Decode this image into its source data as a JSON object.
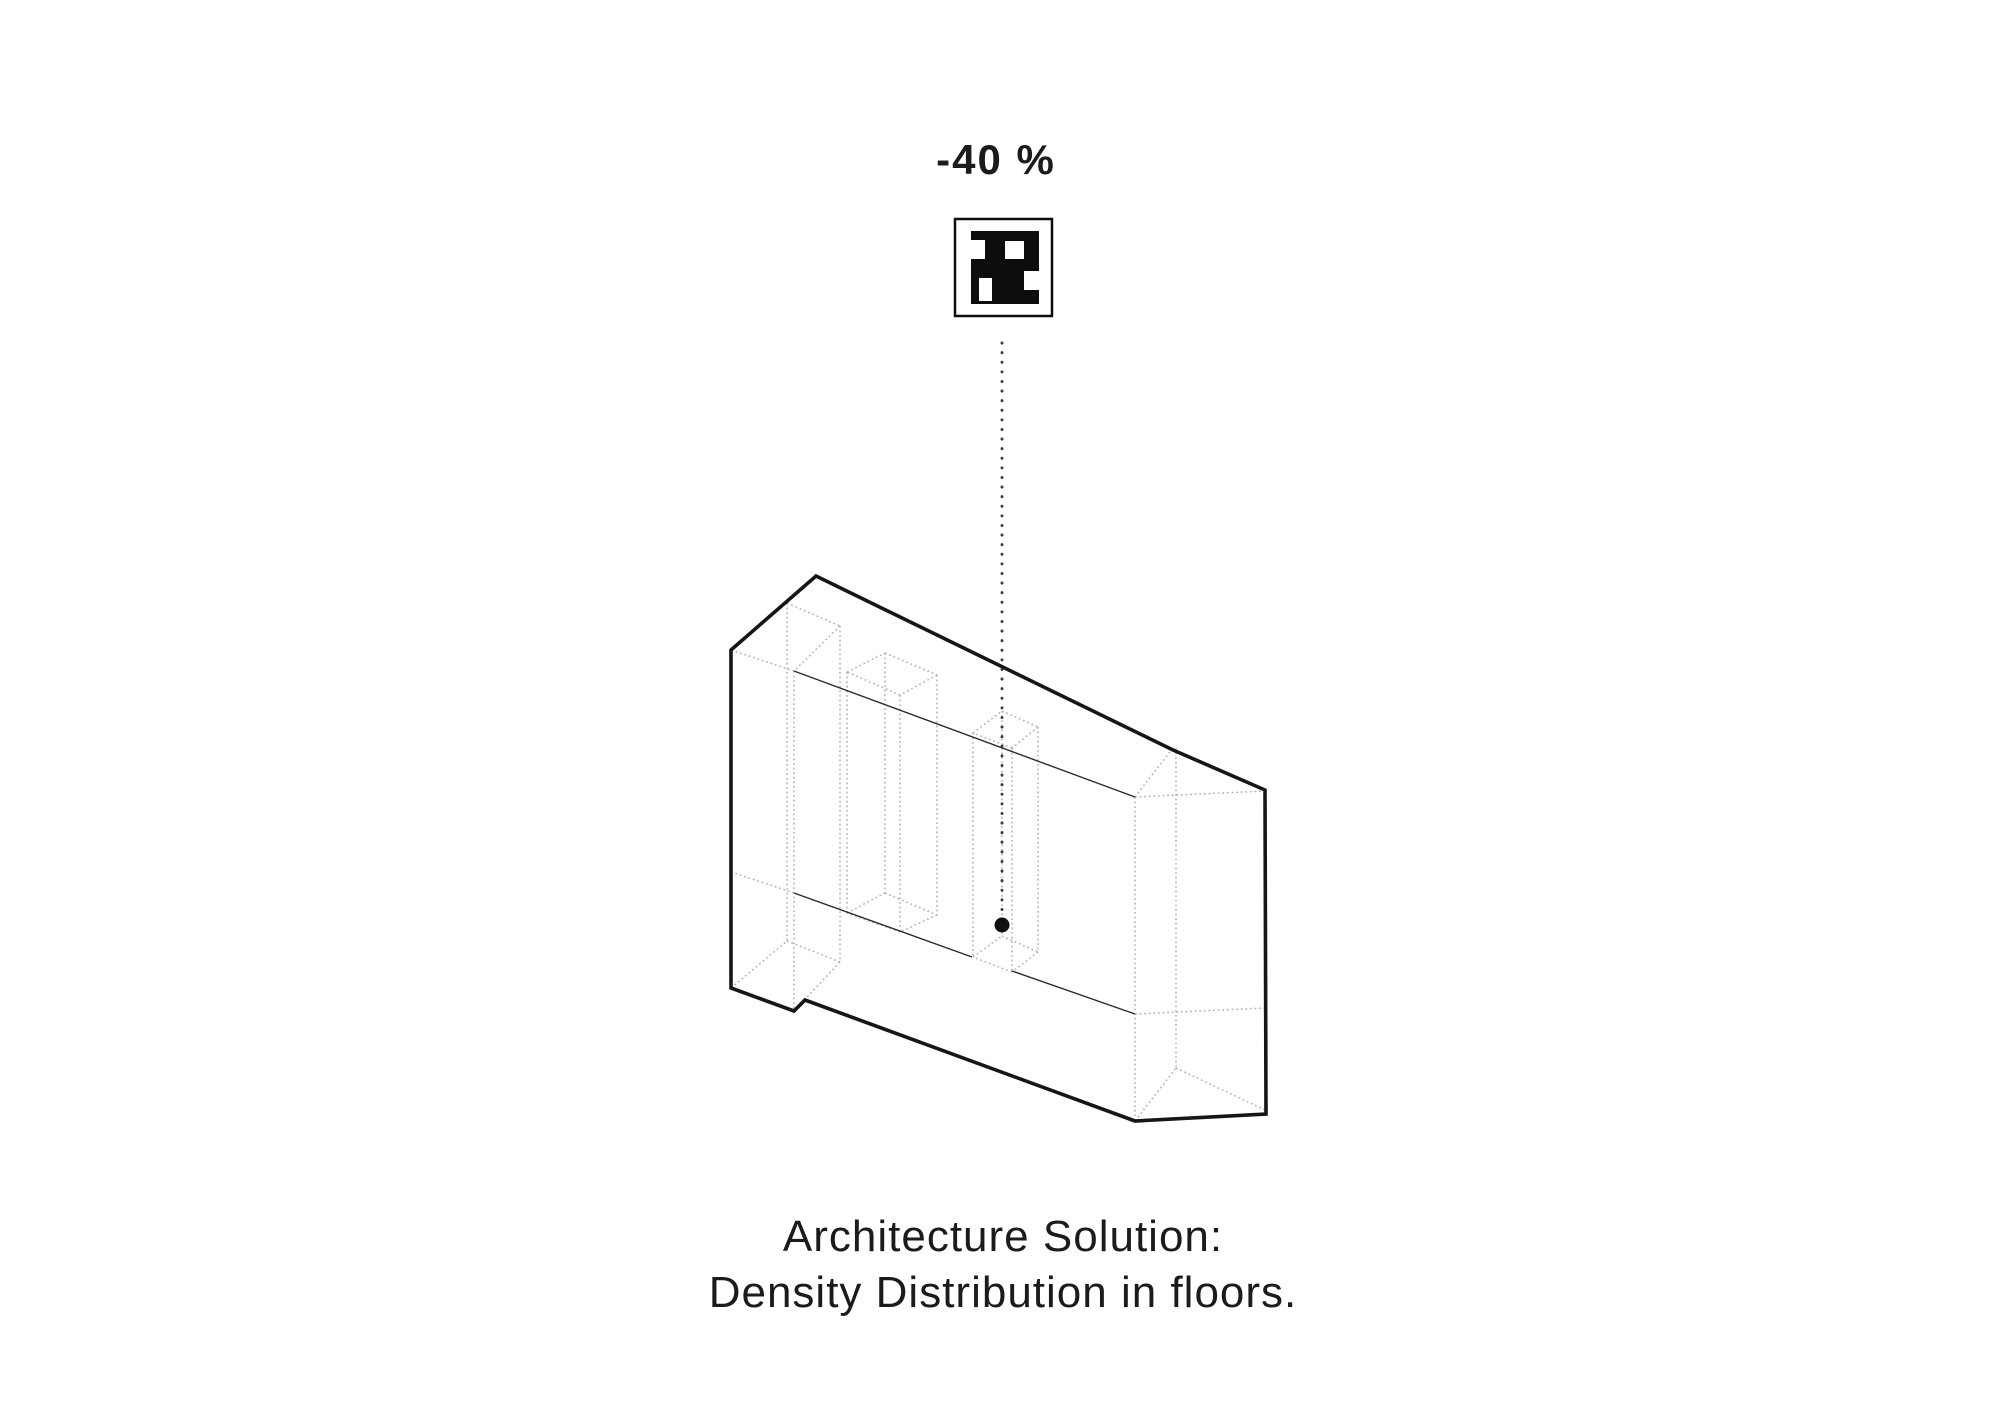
{
  "header": {
    "label": "-40 %"
  },
  "caption": {
    "line1": "Architecture Solution:",
    "line2": "Density Distribution in floors."
  },
  "colors": {
    "background": "#ffffff",
    "outline": "#161616",
    "floor_line": "#2b2b2b",
    "hidden_edge": "#b2b2b2",
    "pointer": "#3a3a3a",
    "dot": "#101010",
    "marker_black": "#0d0d0d",
    "text": "#1b1b1b"
  },
  "marker": {
    "border": {
      "x": 955,
      "y": 219,
      "w": 97,
      "h": 97
    },
    "black_base": {
      "x": 971,
      "y": 231,
      "w": 68,
      "h": 73
    },
    "white_cells": [
      {
        "x": 971,
        "y": 240,
        "w": 14,
        "h": 19
      },
      {
        "x": 1005,
        "y": 241,
        "w": 19,
        "h": 18
      },
      {
        "x": 1024,
        "y": 271,
        "w": 15,
        "h": 19
      },
      {
        "x": 979,
        "y": 278,
        "w": 13,
        "h": 23
      }
    ]
  },
  "pointer": {
    "x": 1002,
    "y1": 343,
    "y2": 916,
    "dot": {
      "cx": 1002,
      "cy": 925,
      "r": 7.5
    }
  },
  "building": {
    "outline": [
      [
        816,
        576
      ],
      [
        1173,
        750
      ],
      [
        1265,
        790
      ],
      [
        1266,
        1114
      ],
      [
        1135,
        1121
      ],
      [
        805,
        1000
      ],
      [
        794,
        1011
      ],
      [
        731,
        988
      ],
      [
        731,
        650
      ]
    ],
    "floor_lines": [
      [
        794,
        671,
        1135,
        797
      ],
      [
        794,
        893,
        972,
        957
      ],
      [
        1012,
        971,
        1135,
        1014
      ]
    ],
    "hidden_edges": [
      [
        731,
        650,
        787,
        603
      ],
      [
        787,
        603,
        840,
        626
      ],
      [
        840,
        626,
        794,
        671
      ],
      [
        794,
        671,
        731,
        650
      ],
      [
        787,
        603,
        787,
        941
      ],
      [
        840,
        626,
        840,
        962
      ],
      [
        794,
        671,
        794,
        1011
      ],
      [
        731,
        988,
        787,
        941
      ],
      [
        787,
        941,
        840,
        962
      ],
      [
        840,
        962,
        794,
        1011
      ],
      [
        731,
        872,
        794,
        893
      ],
      [
        847,
        672,
        885,
        653
      ],
      [
        885,
        653,
        937,
        675
      ],
      [
        937,
        675,
        900,
        695
      ],
      [
        900,
        695,
        847,
        672
      ],
      [
        847,
        672,
        847,
        913
      ],
      [
        885,
        653,
        885,
        893
      ],
      [
        937,
        675,
        937,
        915
      ],
      [
        900,
        695,
        900,
        932
      ],
      [
        847,
        913,
        885,
        893
      ],
      [
        885,
        893,
        937,
        915
      ],
      [
        937,
        915,
        900,
        932
      ],
      [
        900,
        932,
        847,
        913
      ],
      [
        973,
        733,
        1002,
        711
      ],
      [
        1002,
        711,
        1038,
        727
      ],
      [
        1038,
        727,
        1012,
        748
      ],
      [
        1012,
        748,
        973,
        733
      ],
      [
        973,
        733,
        973,
        957
      ],
      [
        1002,
        711,
        1002,
        936
      ],
      [
        1038,
        727,
        1038,
        952
      ],
      [
        1012,
        748,
        1012,
        972
      ],
      [
        973,
        957,
        1002,
        936
      ],
      [
        1002,
        936,
        1038,
        952
      ],
      [
        1038,
        952,
        1012,
        972
      ],
      [
        1012,
        972,
        973,
        957
      ],
      [
        1135,
        797,
        1173,
        748
      ],
      [
        1135,
        797,
        1265,
        791
      ],
      [
        1135,
        1014,
        1265,
        1008
      ],
      [
        1135,
        797,
        1135,
        1121
      ],
      [
        1176,
        748,
        1176,
        1068
      ],
      [
        1135,
        1121,
        1176,
        1068
      ],
      [
        1176,
        1068,
        1265,
        1110
      ]
    ]
  }
}
